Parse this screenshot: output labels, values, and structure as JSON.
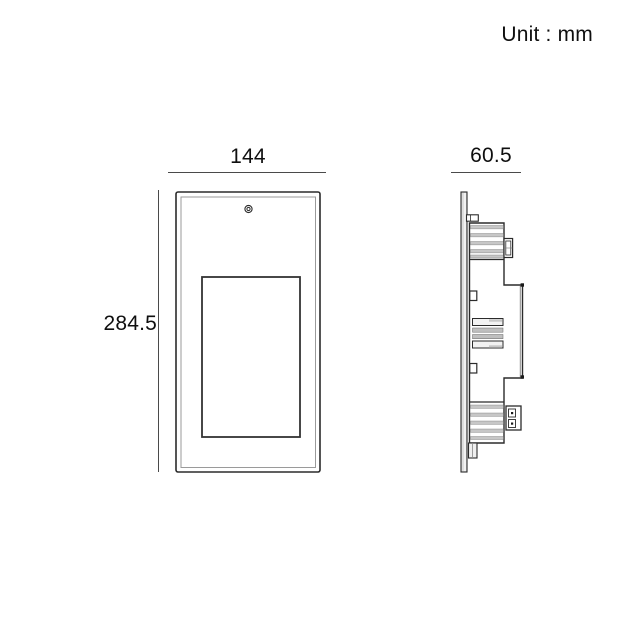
{
  "labels": {
    "unit": "Unit : mm",
    "width": "144",
    "height": "284.5",
    "depth": "60.5"
  },
  "colors": {
    "line": "#2b2b2b",
    "dim_line": "#4a4a4a",
    "inner_frame": "#9a9a9a",
    "band_fill": "#c7c7c7",
    "plate_fill": "#e0e0e0",
    "background": "#ffffff"
  }
}
